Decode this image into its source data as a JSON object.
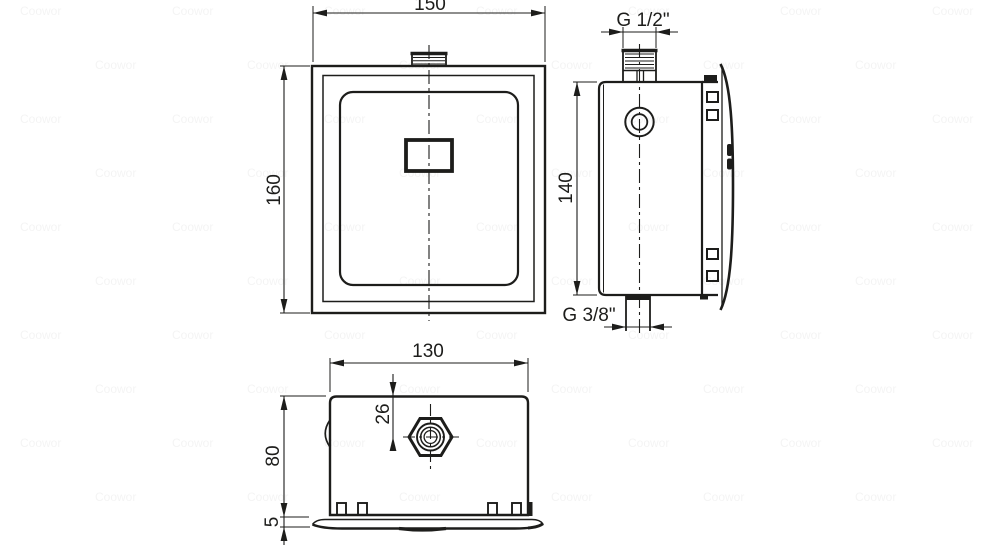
{
  "dimensions": {
    "front_width": "150",
    "front_height": "160",
    "inlet_thread": "G 1/2\"",
    "side_height": "140",
    "outlet_thread": "G 3/8\"",
    "top_width": "130",
    "inlet_offset": "26",
    "body_depth": "80",
    "plate_thickness": "5"
  },
  "watermark": {
    "text": "Coowor"
  },
  "colors": {
    "line": "#1d1d1b",
    "background": "#ffffff"
  }
}
